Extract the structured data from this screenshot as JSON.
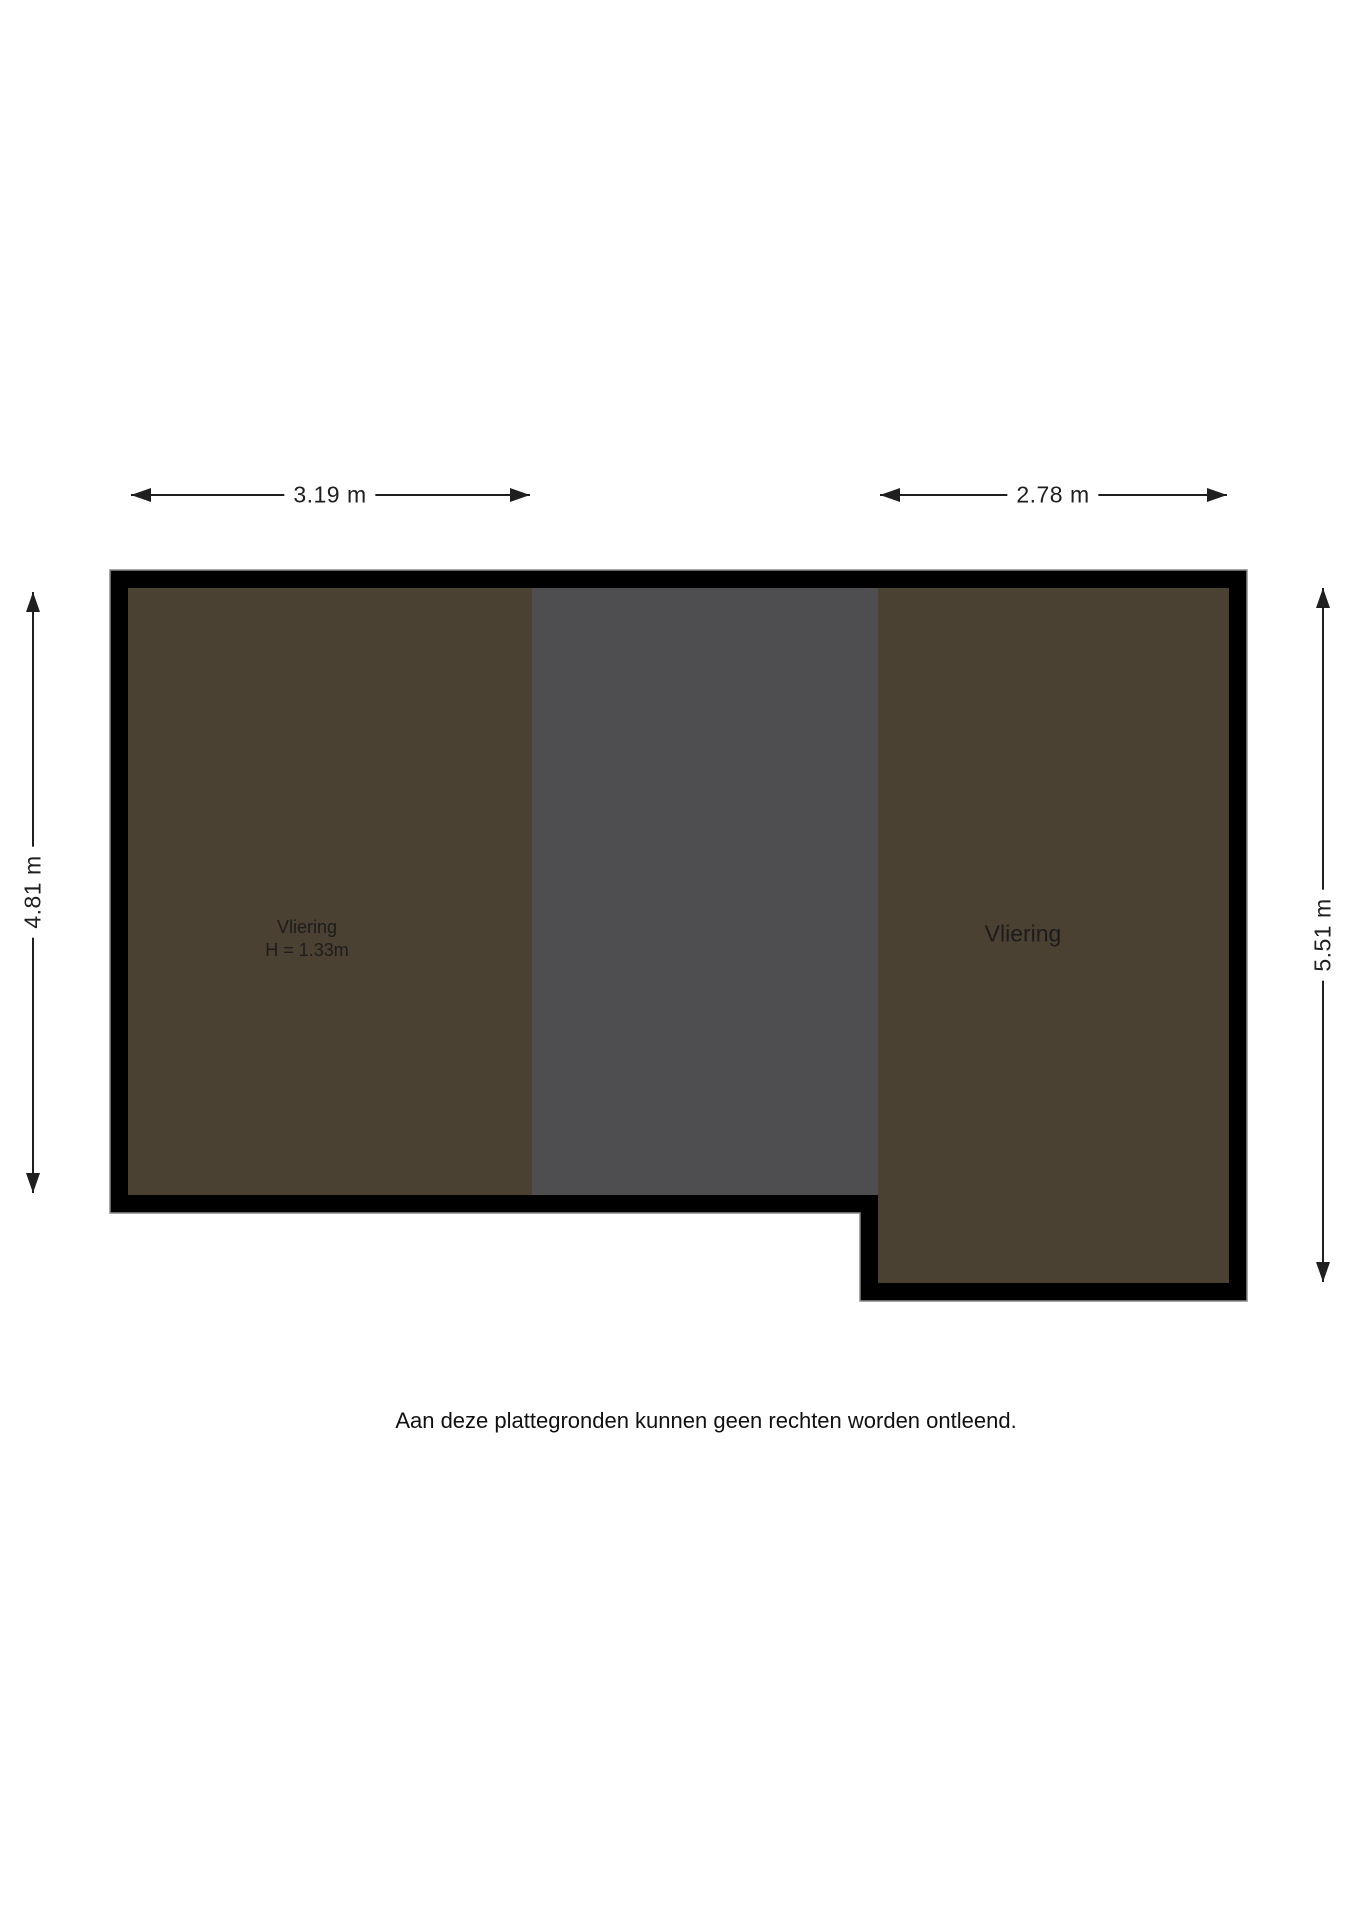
{
  "colors": {
    "background": "#ffffff",
    "wall": "#000000",
    "wall_outline": "#8a8a8a",
    "room_brown": "#4a4132",
    "room_gray": "#4e4d4f",
    "dimension_line": "#1f1f1f",
    "text": "#1c1c1c"
  },
  "rooms": {
    "left": {
      "label": "Vliering",
      "height_label": "H = 1.33m",
      "color": "#4a4132"
    },
    "middle": {
      "color": "#4e4d4f"
    },
    "right": {
      "label": "Vliering",
      "color": "#4a4132"
    }
  },
  "dimensions": {
    "top_left": {
      "label": "3.19 m"
    },
    "top_right": {
      "label": "2.78 m"
    },
    "left": {
      "label": "4.81 m"
    },
    "right": {
      "label": "5.51 m"
    }
  },
  "disclaimer": "Aan deze plattegronden kunnen geen rechten worden ontleend."
}
